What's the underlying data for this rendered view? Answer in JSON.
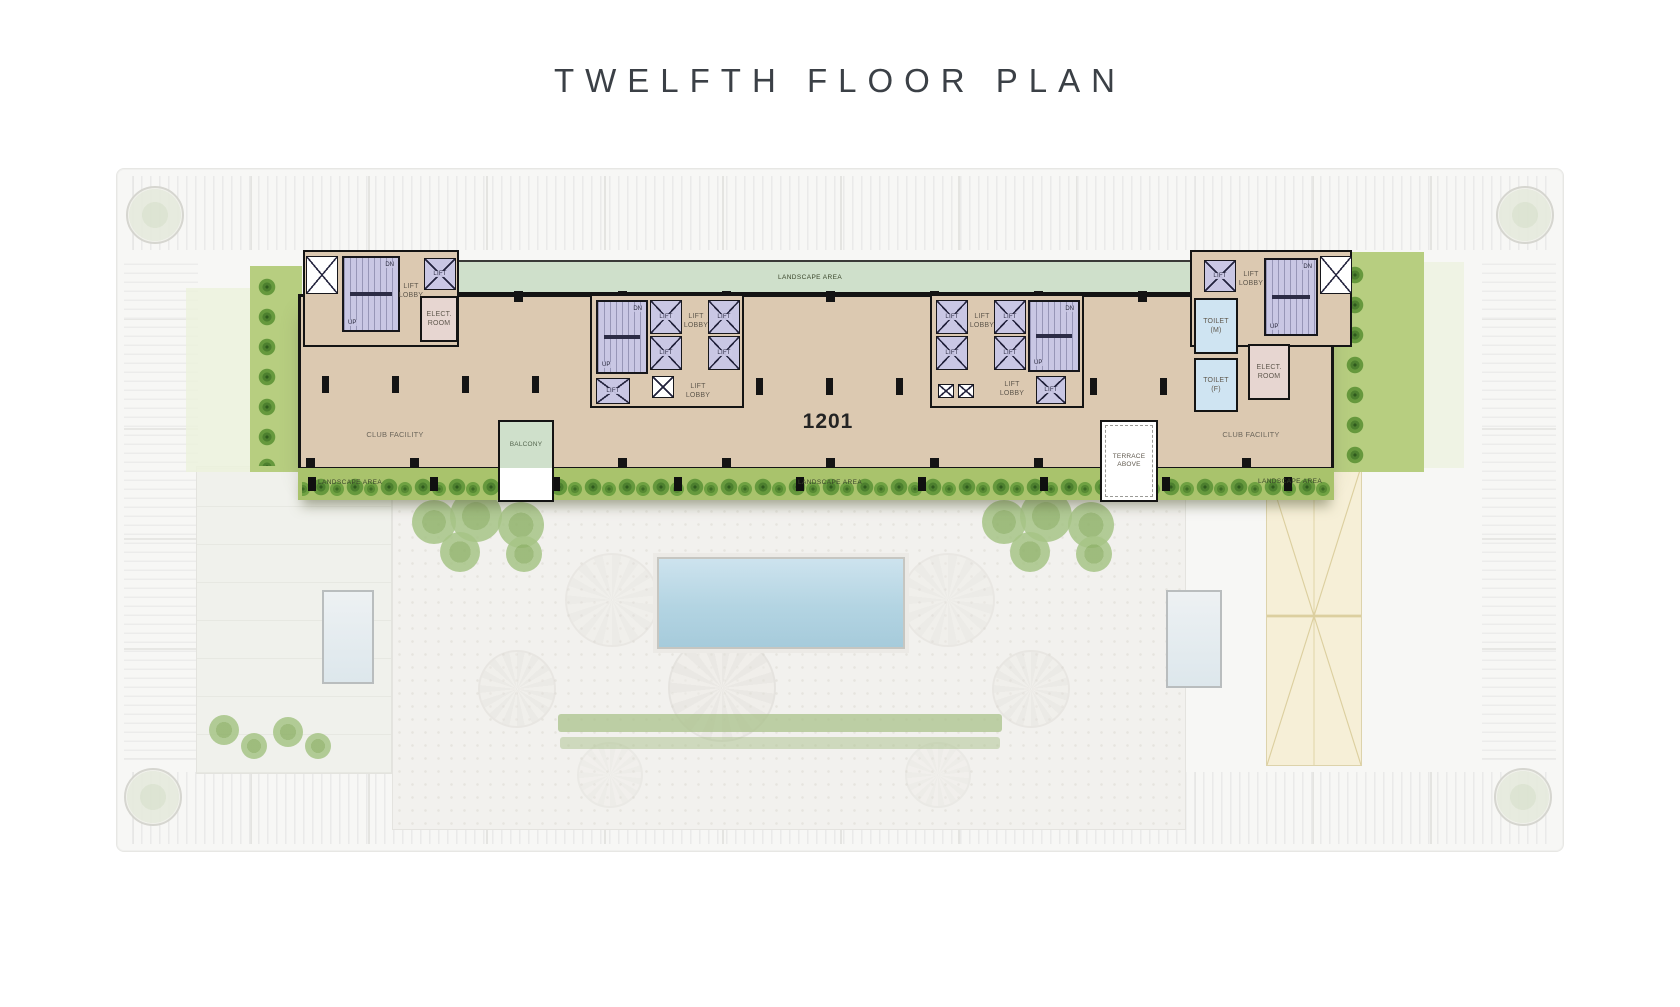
{
  "title": "TWELFTH FLOOR PLAN",
  "plan": {
    "unit_number": "1201",
    "rooms": {
      "club_facility": "CLUB FACILITY",
      "lift_lobby": "LIFT LOBBY",
      "lift": "LIFT",
      "elect_room": "ELECT. ROOM",
      "toilet_m": "TOILET (M)",
      "toilet_f": "TOILET (F)",
      "balcony": "BALCONY",
      "terrace_above": "TERRACE ABOVE"
    },
    "annotations": {
      "landscape_area": "LANDSCAPE AREA",
      "up": "UP",
      "dn": "DN"
    }
  },
  "colors": {
    "wall": "#141414",
    "floor_plate": "#dcc9b1",
    "core_stairs": "#c9c7e4",
    "toilet": "#cfe4f2",
    "elect_room": "#e7d6d1",
    "landscape_top": "#cfe0cb",
    "landscape_band": "#a9c36c",
    "tree": "#4c7f2e",
    "pool": "#b9d7e6",
    "courtyard": "#f2f1ee",
    "sand_terrace": "#f6efd7",
    "title_text": "#3b4046"
  }
}
